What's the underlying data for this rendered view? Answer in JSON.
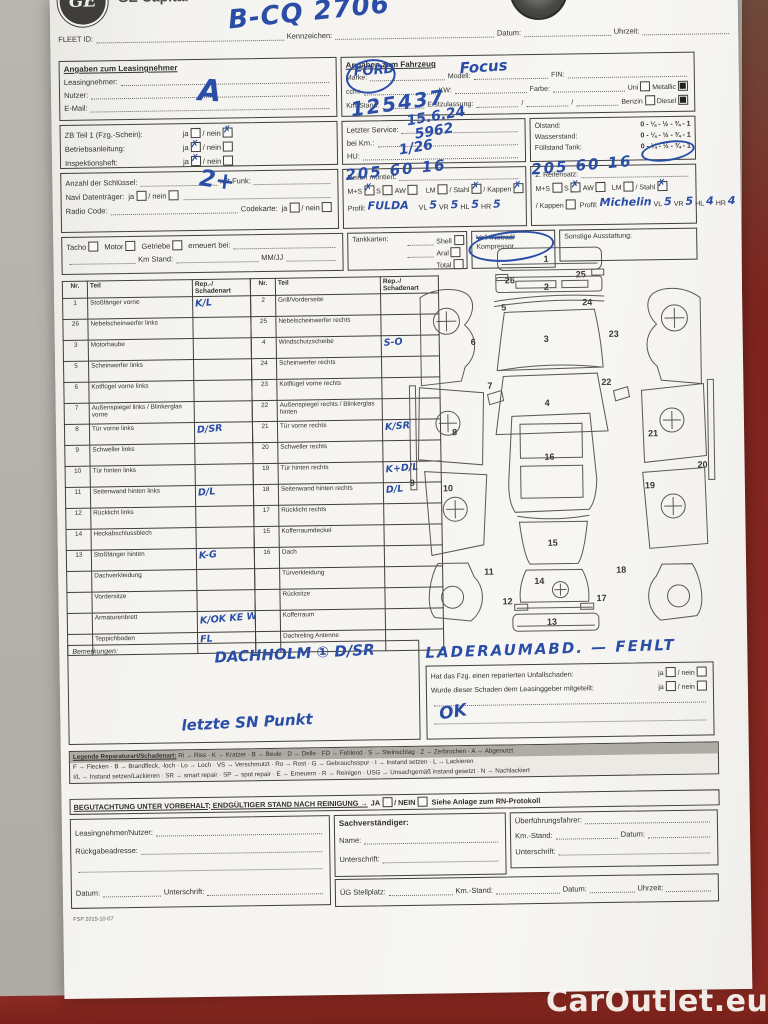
{
  "photo": {
    "watermark": "CarOutlet.eu"
  },
  "header": {
    "brand": "GE Capital",
    "fleet_id_label": "FLEET ID:",
    "kennzeichen_label": "Kennzeichen:",
    "kennzeichen_value": "B-CQ 2706",
    "datum_label": "Datum:",
    "uhrzeit_label": "Uhrzeit:"
  },
  "lessee": {
    "title": "Angaben zum Leasingnehmer",
    "leasingnehmer_label": "Leasingnehmer:",
    "nutzer_label": "Nutzer:",
    "nutzer_value": "A",
    "email_label": "E-Mail:"
  },
  "vehicle": {
    "title": "Angaben zum Fahrzeug",
    "marke_label": "Marke:",
    "marke_value": "FORD",
    "modell_label": "Modell:",
    "modell_value": "Focus",
    "fin_label": "FIN:",
    "ccm_label": "ccm:",
    "kw_label": "KW:",
    "farbe_label": "Farbe:",
    "uni_label": "Uni",
    "uni_mark": "",
    "metallic_label": "Metallic",
    "metallic_mark": "■",
    "km_label": "Km-Stand:",
    "km_value": "125437",
    "erstzulassung_label": "Erstzulassung:",
    "date_sep": "/",
    "benzin_label": "Benzin",
    "benzin_mark": "",
    "diesel_label": "Diesel",
    "diesel_mark": "■"
  },
  "docs": {
    "ja_word": "ja",
    "nein_word": "/ nein",
    "rows": [
      {
        "label": "ZB Teil 1 (Fzg.-Schein):",
        "ja": "",
        "nein": "✗"
      },
      {
        "label": "Betriebsanleitung:",
        "ja": "✗",
        "nein": ""
      },
      {
        "label": "Inspektionsheft:",
        "ja": "✗",
        "nein": ""
      }
    ]
  },
  "service": {
    "letzter_label": "Letzter Service:",
    "bei_km_label": "bei Km.:",
    "hu_label": "HU:",
    "hw_line1": "15.6.24",
    "hw_line2": "5962",
    "hw_line3": "1/26"
  },
  "fluids": {
    "oel_label": "Ölstand:",
    "wasser_label": "Wasserstand:",
    "tank_label": "Füllstand Tank:",
    "scale": "0 - ¼ - ½ - ¾ - 1"
  },
  "keys": {
    "anzahl_label": "Anzahl der Schlüssel:",
    "mit_funk_label": "mit Funk:",
    "funk_value": "2+",
    "navi_label": "Navi Datenträger:",
    "radio_label": "Radio Code:",
    "codekarte_label": "Codekarte:",
    "ja_word": "ja",
    "nein_word": "/ nein"
  },
  "tires1": {
    "title": "Reifen montiert:",
    "size_value": "205 60 16",
    "ms_label": "M+S",
    "ms_mark": "✗",
    "s_label": "S",
    "s_mark": "",
    "aw_label": "AW",
    "aw_mark": "",
    "lm_label": "LM",
    "lm_mark": "",
    "stahl_label": "/ Stahl",
    "stahl_mark": "✗",
    "kappen_label": "/ Kappen",
    "kappen_mark": "✗",
    "profil_label": "Profil:",
    "profil_value": "FULDA",
    "vl_label": "VL",
    "vl_value": "5",
    "vr_label": "VR",
    "vr_value": "5",
    "hl_label": "HL",
    "hl_value": "5",
    "hr_label": "HR",
    "hr_value": "5"
  },
  "tires2": {
    "title": "2. Reifensatz:",
    "size_value": "205 60 16",
    "ms_label": "M+S",
    "ms_mark": "",
    "s_label": "S",
    "s_mark": "✗",
    "aw_label": "AW",
    "aw_mark": "",
    "lm_label": "LM",
    "lm_mark": "",
    "stahl_label": "/ Stahl",
    "stahl_mark": "✗",
    "kappen_label": "/ Kappen",
    "kappen_mark": "",
    "profil_label": "Profil:",
    "profil_value": "Michelin",
    "vl_label": "VL",
    "vl_value": "5",
    "vr_label": "VR",
    "vr_value": "5",
    "hl_label": "HL",
    "hl_value": "4",
    "hr_label": "HR",
    "hr_value": "4"
  },
  "tacho": {
    "tacho_label": "Tacho",
    "motor_label": "Motor",
    "getriebe_label": "Getriebe",
    "erneuert_label": "erneuert bei:",
    "km_label": "Km Stand:",
    "mmjj_label": "MM/JJ"
  },
  "fuelcards": {
    "title": "Tankkarten:",
    "shell_label": "Shell",
    "aral_label": "Aral",
    "total_label": "Total"
  },
  "spare": {
    "line1": "Voll-/Notrad/",
    "line2": "Kompressor"
  },
  "equipment": {
    "title": "Sonstige Ausstattung:"
  },
  "damage_table": {
    "nr_header": "Nr.",
    "teil_header": "Teil",
    "schaden_header": "Rep.-/ Schadenart",
    "left_rows": [
      {
        "nr": "1",
        "teil": "Stoßfänger vorne",
        "schaden": "K/L"
      },
      {
        "nr": "26",
        "teil": "Nebelscheinwerfer links",
        "schaden": ""
      },
      {
        "nr": "3",
        "teil": "Motorhaube",
        "schaden": ""
      },
      {
        "nr": "5",
        "teil": "Scheinwerfer links",
        "schaden": ""
      },
      {
        "nr": "6",
        "teil": "Kotflügel vorne links",
        "schaden": ""
      },
      {
        "nr": "7",
        "teil": "Außenspiegel links / Blinkerglas vorne",
        "schaden": ""
      },
      {
        "nr": "8",
        "teil": "Tür vorne links",
        "schaden": "D/SR"
      },
      {
        "nr": "9",
        "teil": "Schweller links",
        "schaden": ""
      },
      {
        "nr": "10",
        "teil": "Tür hinten links",
        "schaden": ""
      },
      {
        "nr": "11",
        "teil": "Seitenwand hinten links",
        "schaden": "D/L"
      },
      {
        "nr": "12",
        "teil": "Rücklicht links",
        "schaden": ""
      },
      {
        "nr": "14",
        "teil": "Heckabschlussblech",
        "schaden": ""
      },
      {
        "nr": "13",
        "teil": "Stoßfänger hinten",
        "schaden": "K-G"
      },
      {
        "nr": "",
        "teil": "Dachverkleidung",
        "schaden": ""
      },
      {
        "nr": "",
        "teil": "Vordersitze",
        "schaden": ""
      },
      {
        "nr": "",
        "teil": "Armaturenbrett",
        "schaden": "K/OK KE Wass"
      },
      {
        "nr": "",
        "teil": "Teppichboden",
        "schaden": "FL"
      }
    ],
    "right_rows": [
      {
        "nr": "2",
        "teil": "Grill/Vorderseite",
        "schaden": ""
      },
      {
        "nr": "25",
        "teil": "Nebelscheinwerfer rechts",
        "schaden": ""
      },
      {
        "nr": "4",
        "teil": "Windschutzscheibe",
        "schaden": "S-O"
      },
      {
        "nr": "24",
        "teil": "Scheinwerfer rechts",
        "schaden": ""
      },
      {
        "nr": "23",
        "teil": "Kotflügel vorne rechts",
        "schaden": ""
      },
      {
        "nr": "22",
        "teil": "Außenspiegel rechts / Blinkerglas hinten",
        "schaden": ""
      },
      {
        "nr": "21",
        "teil": "Tür vorne rechts",
        "schaden": "K/SR"
      },
      {
        "nr": "20",
        "teil": "Schweller rechts",
        "schaden": ""
      },
      {
        "nr": "19",
        "teil": "Tür hinten rechts",
        "schaden": "K+D/L"
      },
      {
        "nr": "18",
        "teil": "Seitenwand hinten rechts",
        "schaden": "D/L"
      },
      {
        "nr": "17",
        "teil": "Rücklicht rechts",
        "schaden": ""
      },
      {
        "nr": "15",
        "teil": "Kofferraumdeckel",
        "schaden": ""
      },
      {
        "nr": "16",
        "teil": "Dach",
        "schaden": ""
      },
      {
        "nr": "",
        "teil": "Türverkleidung",
        "schaden": ""
      },
      {
        "nr": "",
        "teil": "Rücksitze",
        "schaden": ""
      },
      {
        "nr": "",
        "teil": "Kofferraum",
        "schaden": ""
      },
      {
        "nr": "",
        "teil": "Dachreling Antenne",
        "schaden": ""
      }
    ]
  },
  "diagram": {
    "front_bumper": "1",
    "grille": "2",
    "hood": "3",
    "windshield": "4",
    "headlight_left": "5",
    "fender_left": "6",
    "mirror_left": "7",
    "door_front_left": "8",
    "sill_left": "9",
    "door_rear_left": "10",
    "quarter_left": "11",
    "taillight_left": "12",
    "rear_bumper": "13",
    "trunk": "14",
    "rear_window": "15",
    "roof": "16",
    "taillight_right": "17",
    "quarter_right": "18",
    "door_rear_right": "19",
    "sill_right": "20",
    "door_front_right": "21",
    "mirror_right": "22",
    "fender_right": "23",
    "headlight_right": "24",
    "fog_right": "25",
    "fog_left": "26"
  },
  "remarks": {
    "title": "Bemerkungen:",
    "hw_line1": "DACHHOLM ① D/SR",
    "hw_line2": "letzte SN Punkt"
  },
  "accident": {
    "hw_note": "LADERAUMABD. — FEHLT",
    "q1": "Hat das Fzg. einen reparierten Unfallschaden:",
    "q2": "Wurde dieser Schaden dem Leasinggeber mitgeteilt:",
    "ja_word": "ja",
    "nein_word": "/ nein",
    "hw_answer": "OK"
  },
  "legend": {
    "title": "Legende Reparaturart/Schadenart:",
    "line1_rest": "Ri → Riss · K → Kratzer · B → Beule · D → Delle · FD → Fehlend · S → Steinschlag · Z → Zerbrochen · A → Abgenutzt",
    "line2": "F → Flecken · B → Brandfleck, -loch · Lo → Loch · VS → Verschmutzt · Ro → Rost · G → Gebrauchsspur · I → Instand setzen · L → Lackieren",
    "line3": "I/L → Instand setzen/Lackieren · SR → smart repair · SP → spot repair · E → Erneuern · R → Reinigen · USG → Unsachgemäß instand gesetzt · N → Nachlackiert"
  },
  "assessment": {
    "text": "BEGUTACHTUNG UNTER VORBEHALT; ENDGÜLTIGER STAND NACH REINIGUNG →",
    "ja_word": "JA",
    "sep": "/",
    "nein_word": "NEIN",
    "suffix": "Siehe Anlage zum RN-Protokoll"
  },
  "signatures": {
    "lessee_label": "Leasingnehmer/Nutzer:",
    "address_label": "Rückgabeadresse:",
    "datum_label": "Datum:",
    "unterschrift_label": "Unterschrift:",
    "expert_title": "Sachverständiger:",
    "name_label": "Name:",
    "driver_label": "Überführungsfahrer:",
    "km_label": "Km.-Stand:",
    "stellplatz_label": "ÜG Stellplatz:",
    "uhrzeit_label": "Uhrzeit:"
  },
  "footer": {
    "code": "FSP 2015-10-07"
  }
}
